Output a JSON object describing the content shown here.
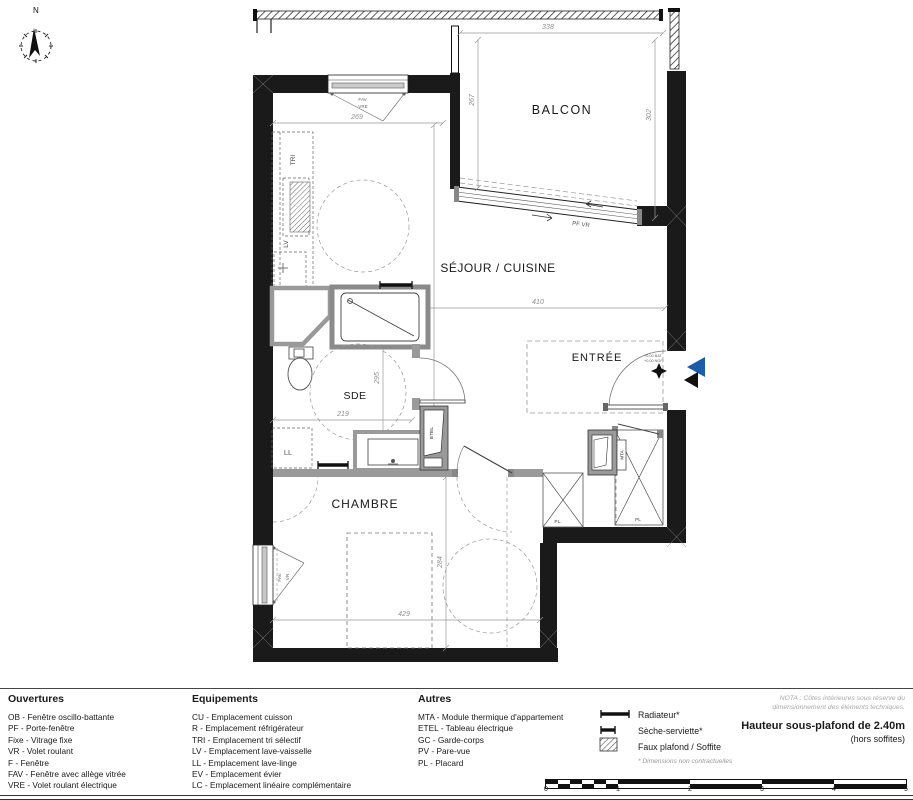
{
  "plan": {
    "compass_label": "N",
    "rooms": {
      "balcon": "BALCON",
      "sejour": "SÉJOUR / CUISINE",
      "entree": "ENTRÉE",
      "sde": "SDE",
      "chambre": "CHAMBRE"
    },
    "dims": {
      "balcon_width": "338",
      "balcon_left": "267",
      "balcon_right": "302",
      "cuisine_width": "269",
      "sejour_width": "410",
      "sejour_depth": "445",
      "sde_depth": "295",
      "sde_width": "219",
      "chambre_width": "429",
      "chambre_depth": "284"
    },
    "openings": {
      "pf_vr": "PF VR",
      "fav_top_1": "FAV.",
      "fav_top_2": "VRE",
      "fav_left_1": "FAV.",
      "fav_left_2": "VR"
    },
    "equipment": {
      "tri": "TRI",
      "lv": "LV",
      "ll": "LL",
      "etel": "ETEL",
      "mta": "MTA",
      "pl_small": "PL.",
      "pl_large": "PL"
    },
    "entrance": {
      "level_line1": "+0,00 BAT",
      "level_line2": "+0,00 NGF"
    }
  },
  "legend": {
    "columns": [
      {
        "title": "Ouvertures",
        "items": [
          "OB - Fenêtre oscillo-battante",
          "PF - Porte-fenêtre",
          "Fixe - Vitrage fixe",
          "VR - Volet roulant",
          "F - Fenêtre",
          "FAV - Fenêtre avec allège vitrée",
          "VRE - Volet roulant électrique"
        ]
      },
      {
        "title": "Equipements",
        "items": [
          "CU - Emplacement cuisson",
          "R - Emplacement réfrigérateur",
          "TRI - Emplacement tri sélectif",
          "LV - Emplacement lave-vaisselle",
          "LL - Emplacement lave-linge",
          "EV - Emplacement évier",
          "LC - Emplacement linéaire complémentaire"
        ]
      },
      {
        "title": "Autres",
        "items": [
          "MTA - Module thermique d'appartement",
          "ETEL - Tableau électrique",
          "GC - Garde-corps",
          "PV - Pare-vue",
          "PL - Placard"
        ]
      }
    ],
    "symbols": [
      {
        "name": "radiator",
        "label": "Radiateur*"
      },
      {
        "name": "towel-dryer",
        "label": "Sèche-serviette*"
      },
      {
        "name": "soffit",
        "label": "Faux plafond / Soffite"
      }
    ],
    "footnote": "* Dimensions non contractuelles"
  },
  "notes": {
    "nota_line1": "NOTA : Côtes intérieures sous réserve du",
    "nota_line2": "dimensionnement des éléments techniques.",
    "ceiling": "Hauteur sous-plafond de 2.40m",
    "ceiling_sub": "(hors soffites)"
  },
  "scale_bar": {
    "ticks": [
      "0",
      "1",
      "2",
      "3",
      "4",
      "5"
    ]
  },
  "colors": {
    "wall": "#1a1a1a",
    "partition": "#9a9a9a",
    "accent_blue": "#1d5da8",
    "dim_gray": "#8f8f8f"
  }
}
